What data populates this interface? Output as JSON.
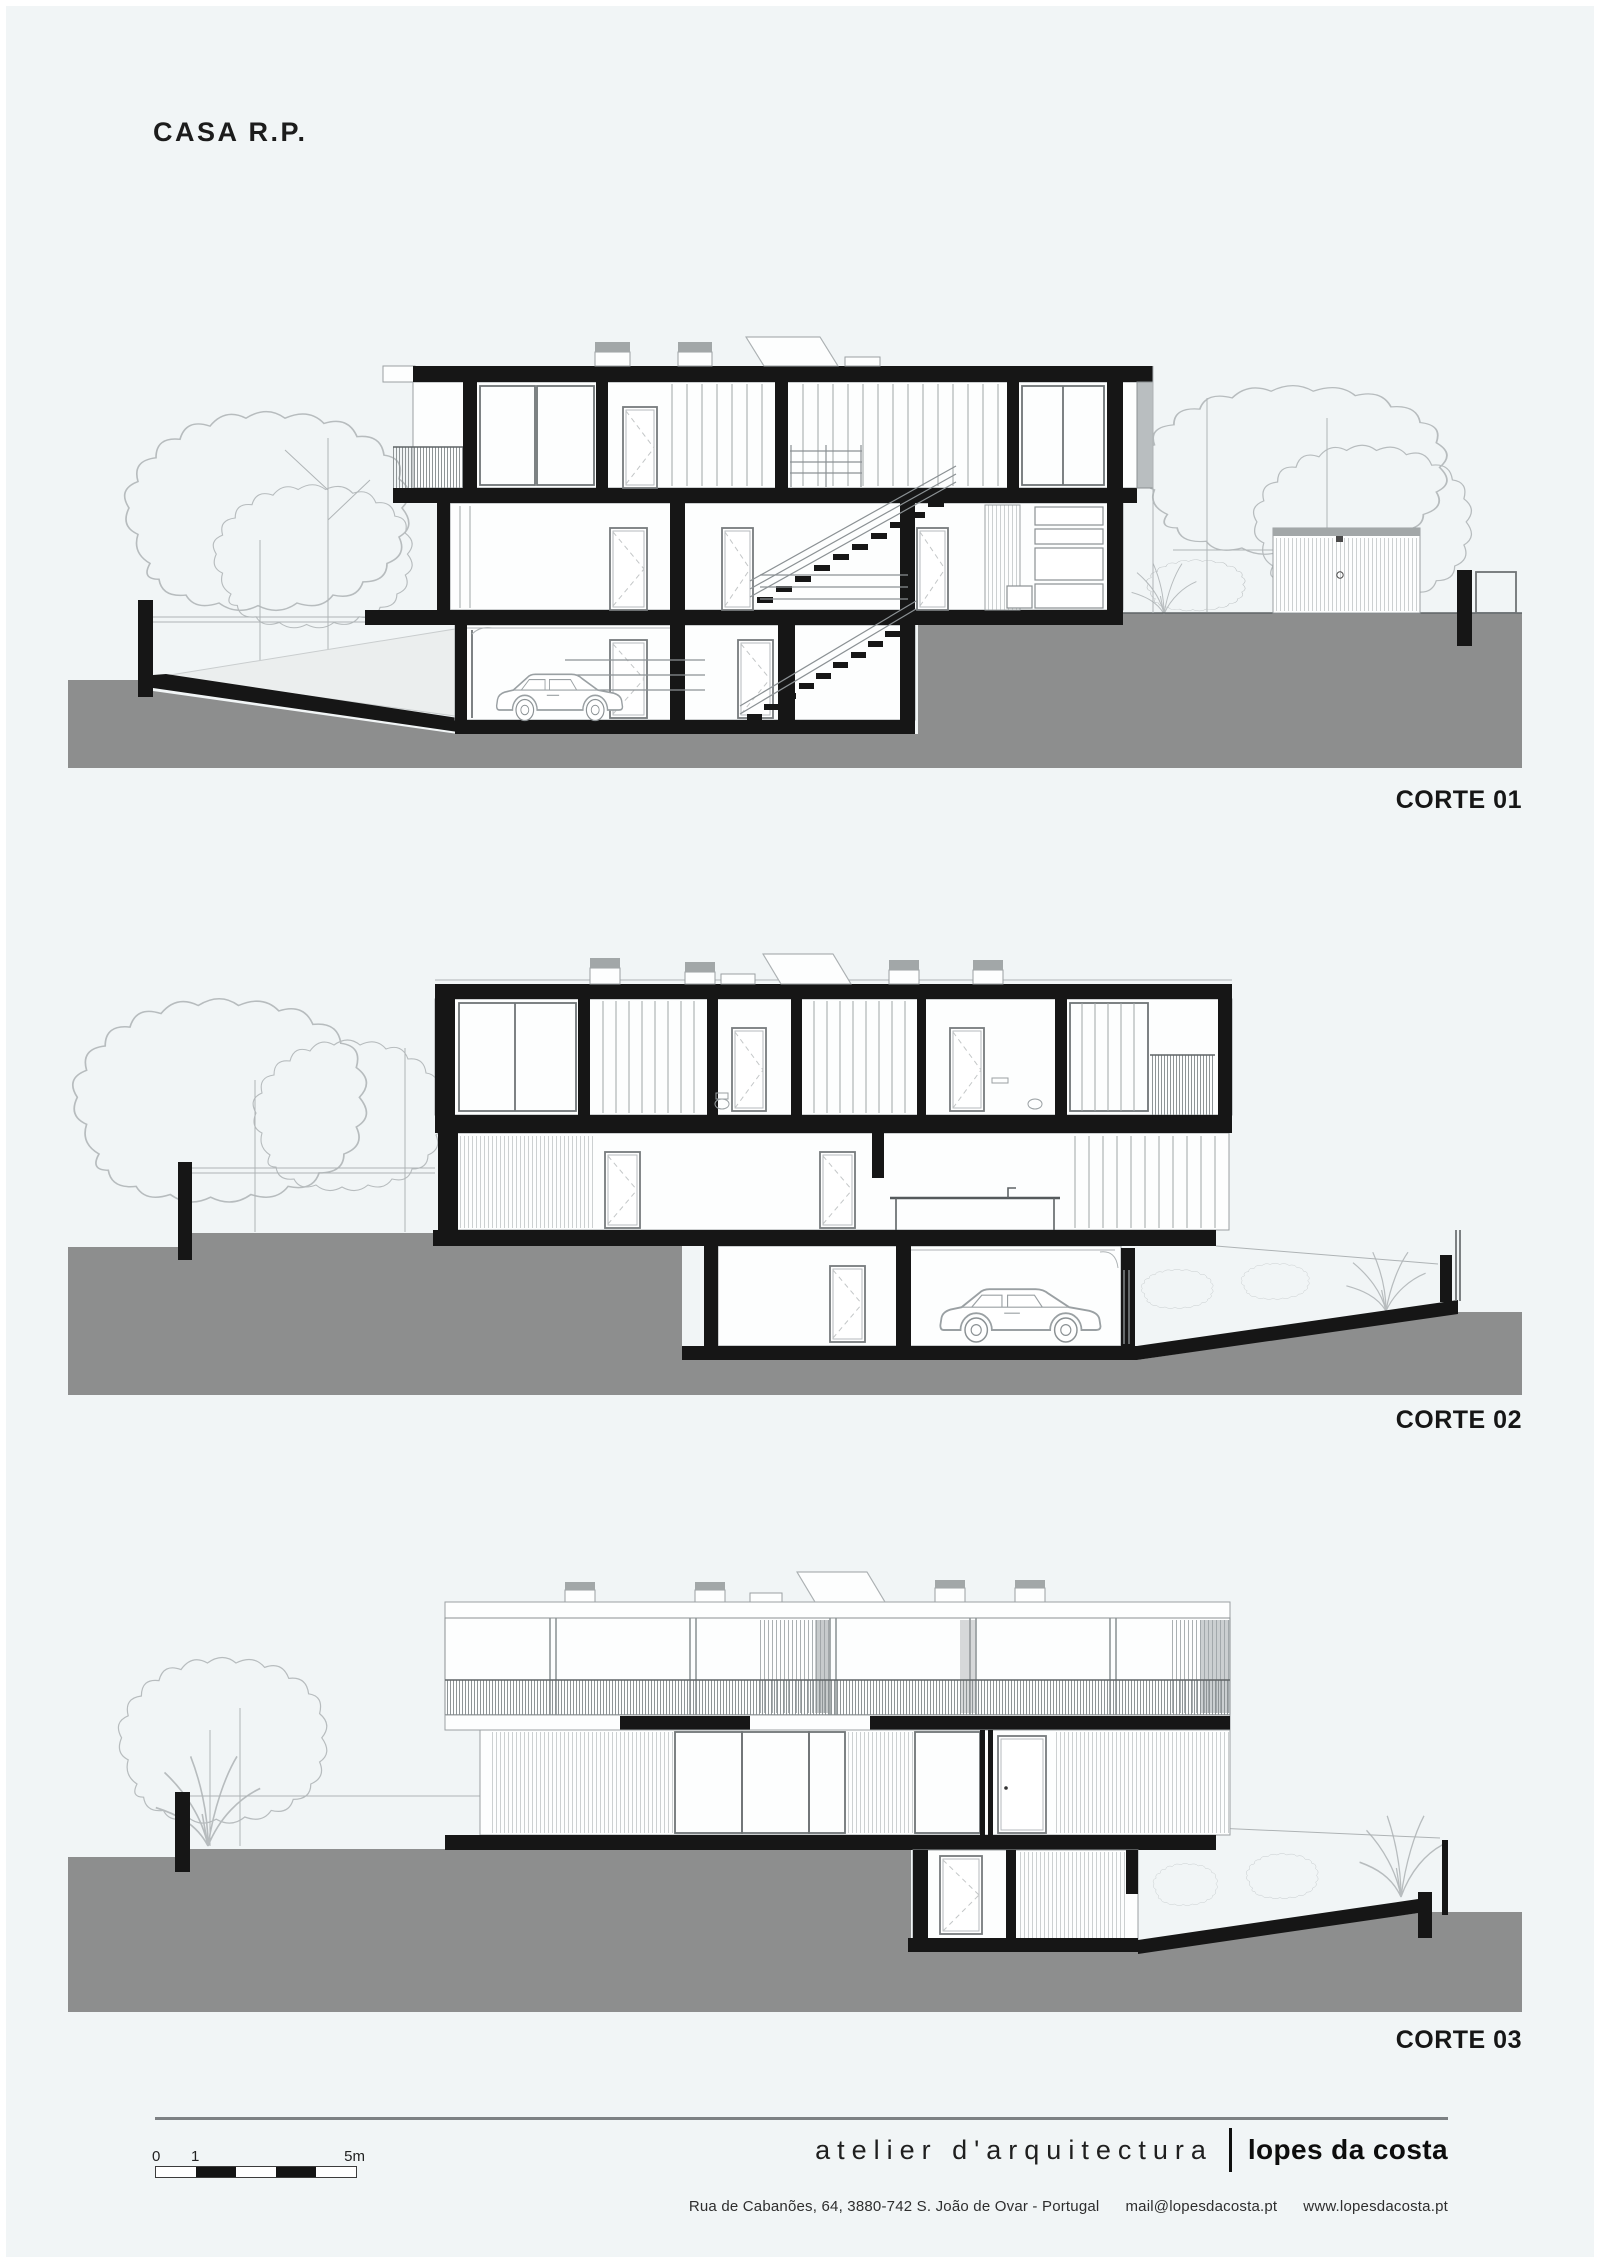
{
  "page": {
    "title": "CASA R.P."
  },
  "sections": [
    {
      "id": "corte-01",
      "label": "CORTE 01"
    },
    {
      "id": "corte-02",
      "label": "CORTE 02"
    },
    {
      "id": "corte-03",
      "label": "CORTE 03"
    }
  ],
  "scale_bar": {
    "tick_start": "0",
    "tick_one": "1",
    "tick_end": "5m"
  },
  "footer": {
    "studio_name_light": "atelier d'arquitectura",
    "studio_name_bold": "lopes da costa",
    "address": "Rua de Cabanões,  64,  3880-742  S. João de Ovar - Portugal",
    "email": "mail@lopesdacosta.pt",
    "website": "www.lopesdacosta.pt"
  },
  "colors": {
    "background": "#f1f5f6",
    "ground": "#8d8e8e",
    "ink": "#161616",
    "vegetation_line": "#b7bcbe"
  }
}
